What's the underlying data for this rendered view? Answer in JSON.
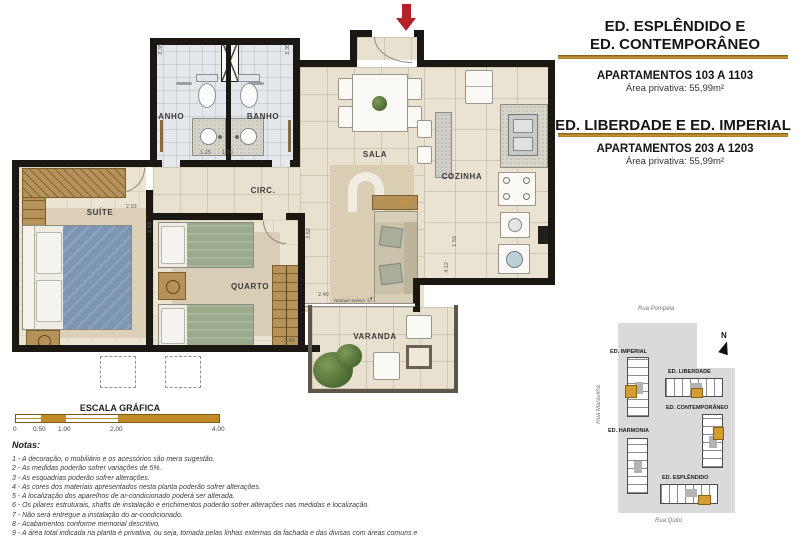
{
  "palette": {
    "accent_gold": "#b5811c",
    "wall_black": "#1b1813",
    "entry_arrow_red": "#b72026",
    "suite_bed_blue": "#7e96b6",
    "quarto_bed_green": "#9caa8c",
    "site_lot_gray": "#dadada",
    "unit_highlight_gold": "#d59c2f"
  },
  "header": {
    "title1_line1": "ED. ESPLÊNDIDO E",
    "title1_line2": "ED. CONTEMPORÂNEO",
    "apartments1": "APARTAMENTOS 103 A 1103",
    "area1": "Área privativa: 55,99m²",
    "title2": "ED. LIBERDADE E ED. IMPERIAL",
    "apartments2": "APARTAMENTOS 203 A 1203",
    "area2": "Área privativa: 55,99m²"
  },
  "floorplan": {
    "rooms": {
      "suite": "SUÍTE",
      "quarto": "QUARTO",
      "banho_left": "BANHO",
      "banho_right": "BANHO",
      "circ": "CIRC.",
      "sala": "SALA",
      "cozinha": "COZINHA",
      "varanda": "VARANDA"
    },
    "annotation": "Rodapé Soleira",
    "dimensions": [
      "2.35",
      "2.35",
      "1.25",
      "1.20",
      "2.93",
      "2.63",
      "2.62",
      "2.40",
      "3.43",
      "1.53",
      "4.12"
    ]
  },
  "scalebar": {
    "title": "ESCALA GRÁFICA",
    "ticks": [
      "0",
      "0.50",
      "1.00",
      "2.00",
      "4.00"
    ]
  },
  "notes": {
    "title": "Notas:",
    "lines": [
      "1 - A decoração, o mobiliário e os acessórios são mera sugestão.",
      "2 - As medidas poderão sofrer variações de 5%.",
      "3 - As esquadrias poderão sofrer alterações.",
      "4 - As cores dos materiais apresentados nesta planta poderão sofrer alterações.",
      "5 - A localização dos aparelhos de ar-condicionado poderá ser alterada.",
      "6 - Os pilares estruturais, shafts de instalação e enchimentos poderão sofrer alterações nas medidas e localização.",
      "7 - Não será entregue a instalação do ar-condicionado.",
      "8 - Acabamentos conforme memorial descritivo.",
      "9 - A área total indicada na planta é privativa, ou seja, tomada pelas linhas externas da fachada e das divisas com áreas comuns e",
      "pelo eixo das paredes divisórias entre apartamentos, conforme descrito na NBR 12.721 ABNT.",
      "Já as cotas indicadas nos compartimentos internos são úteis, desconsiderando paredes e outros elementos construtivos conforme NBR 14.653-2 ABNT."
    ]
  },
  "siteplan": {
    "north_label": "N",
    "streets": {
      "top": "Rua Pompéia",
      "left": "Rua Maravilha",
      "bottom": "Rua Quito"
    },
    "buildings": [
      {
        "name": "ED. IMPERIAL"
      },
      {
        "name": "ED. LIBERDADE"
      },
      {
        "name": "ED. CONTEMPORÂNEO"
      },
      {
        "name": "ED. HARMONIA"
      },
      {
        "name": "ED. ESPLÊNDIDO"
      }
    ]
  }
}
